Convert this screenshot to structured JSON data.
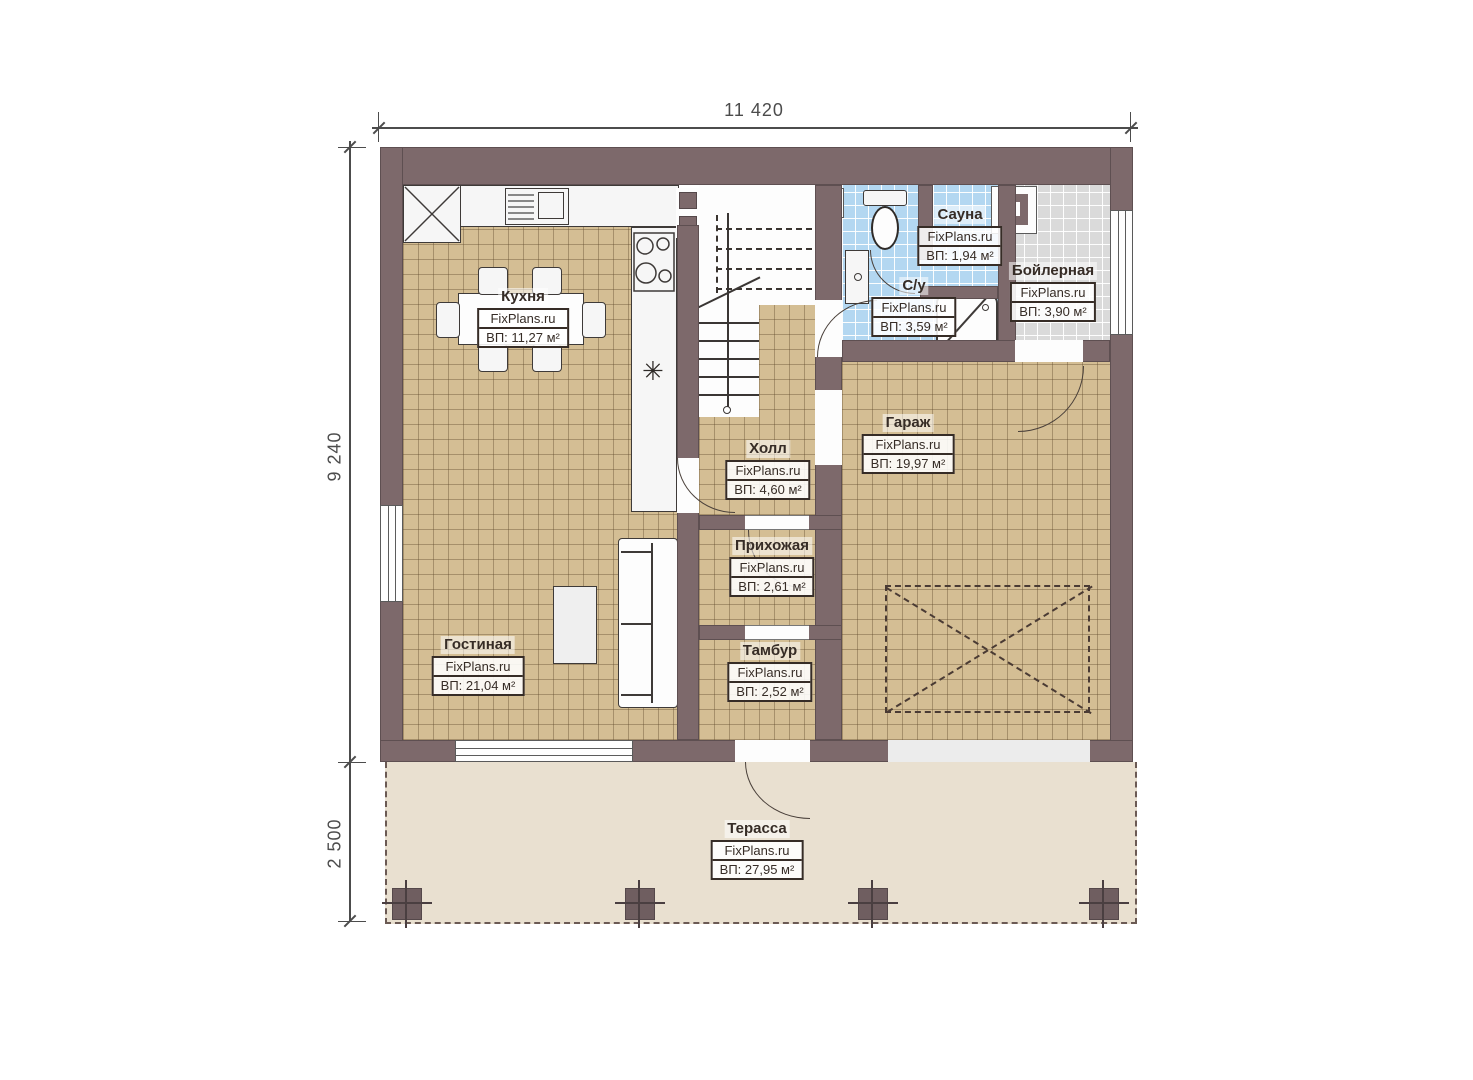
{
  "plan": {
    "type": "floor-plan",
    "source_watermark": "FixPlans.ru"
  },
  "dimensions": {
    "top_width": "11 420",
    "left_height": "9 240",
    "terrace_depth": "2 500"
  },
  "rooms": [
    {
      "name": "Кухня",
      "brand": "FixPlans.ru",
      "area": "ВП: 11,27 м²"
    },
    {
      "name": "Сауна",
      "brand": "FixPlans.ru",
      "area": "ВП: 1,94 м²"
    },
    {
      "name": "Бойлерная",
      "brand": "FixPlans.ru",
      "area": "ВП: 3,90 м²"
    },
    {
      "name": "С/у",
      "brand": "FixPlans.ru",
      "area": "ВП: 3,59 м²"
    },
    {
      "name": "Гараж",
      "brand": "FixPlans.ru",
      "area": "ВП: 19,97 м²"
    },
    {
      "name": "Холл",
      "brand": "FixPlans.ru",
      "area": "ВП: 4,60 м²"
    },
    {
      "name": "Прихожая",
      "brand": "FixPlans.ru",
      "area": "ВП: 2,61 м²"
    },
    {
      "name": "Тамбур",
      "brand": "FixPlans.ru",
      "area": "ВП: 2,52 м²"
    },
    {
      "name": "Гостиная",
      "brand": "FixPlans.ru",
      "area": "ВП: 21,04 м²"
    },
    {
      "name": "Терасса",
      "brand": "FixPlans.ru",
      "area": "ВП: 27,95 м²"
    }
  ],
  "icons": {
    "fridge_symbol": "✳"
  },
  "colors": {
    "wall": "#7d696b",
    "floor_tile": "#d4be94",
    "wet_tile": "#b3d7f1",
    "boiler_tile": "#dadada",
    "terrace": "#e9e0d0"
  }
}
